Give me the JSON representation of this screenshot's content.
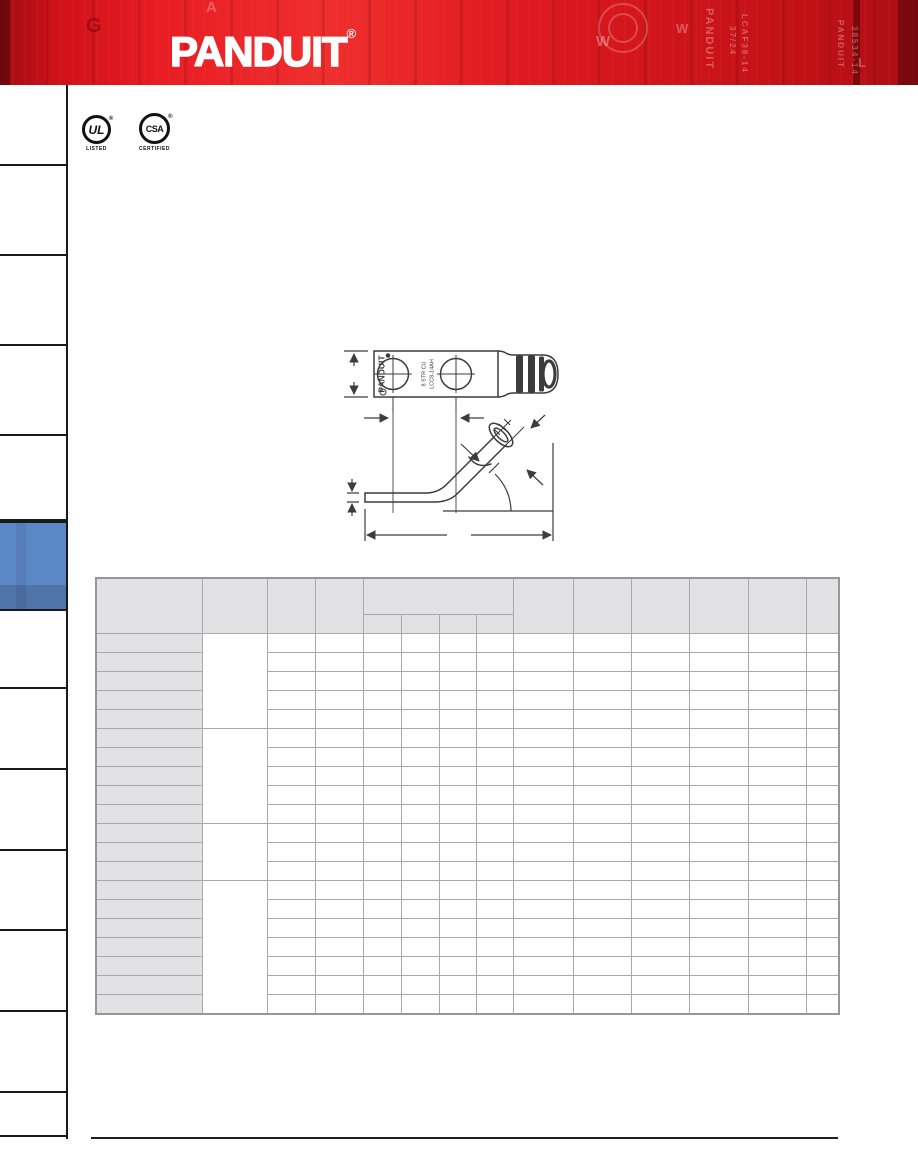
{
  "banner": {
    "logo_text": "PANDUIT",
    "registered_mark": "®",
    "background_red": "#dd1a21",
    "watermarks": {
      "letters": [
        "G",
        "A",
        "W",
        "W",
        "L"
      ],
      "vertical_texts": [
        "PANDUIT",
        "37/24",
        "LCAF38-14",
        "PANDUIT",
        "38534-14"
      ]
    }
  },
  "certifications": {
    "ul": {
      "letters": "UL",
      "caption": "LISTED",
      "registered_mark": "®"
    },
    "csa": {
      "letters": "CSA",
      "caption": "CERTIFIED",
      "registered_mark": "®"
    }
  },
  "product_photo": {
    "stamp": "8 STR CU",
    "barrel_marking": "PANDUIT"
  },
  "drawings": {
    "top_view": {
      "brand": "PANDUIT",
      "marking_line1": "8 STR CU",
      "marking_line2": "LCC8-14AH"
    }
  },
  "sidebar": {
    "tab_count": 13,
    "active_index": 5,
    "active_color": "#5884c4"
  },
  "spec_table": {
    "column_count": 14,
    "header_rows": 2,
    "merged_header_subcolumns": 4,
    "row_groups": [
      5,
      5,
      3,
      7
    ],
    "total_body_rows": 20,
    "header_bg": "#e2e2e4",
    "row_label_bg": "#e2e2e4",
    "grid_color": "#a9a9ab",
    "cells_empty": true
  }
}
